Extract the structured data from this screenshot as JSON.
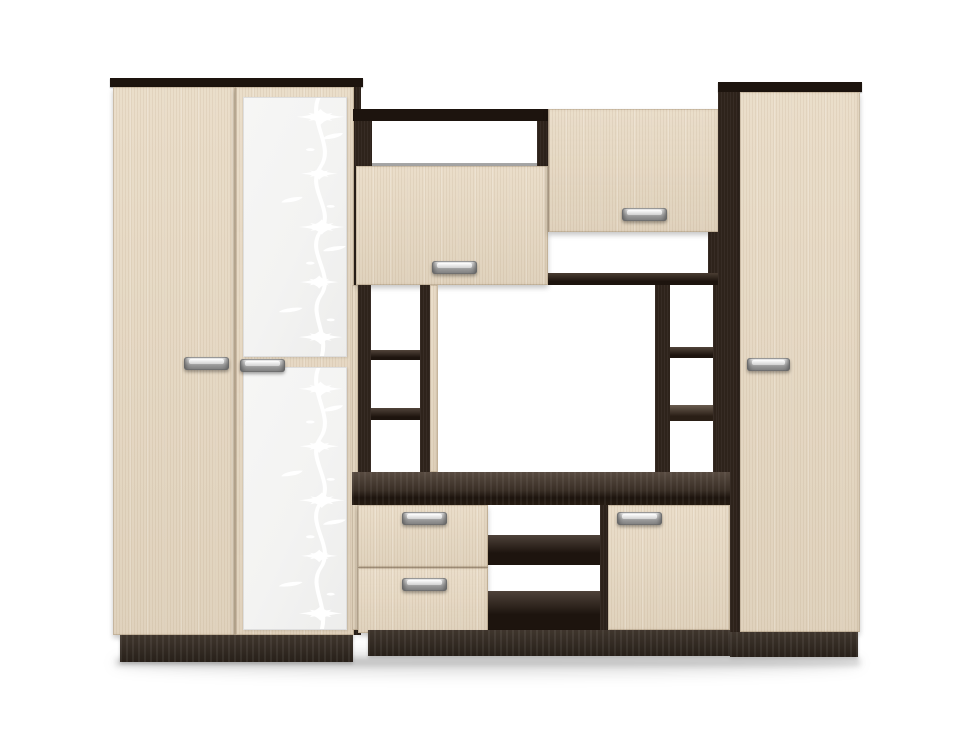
{
  "scene": {
    "kind": "furniture-product-render",
    "object": "living-room wall unit: two-door wardrobe with patterned glass, open TV section with shelves and drawers, tall side cabinet",
    "background": "#ffffff"
  },
  "colors": {
    "background": "#ffffff",
    "wood_light": "#e8dac4",
    "wood_grain": "#d3c1a5",
    "wood_edge": "#cdbb9e",
    "carcass_dark": "#2e231b",
    "carcass_deep": "#1d140e",
    "stand_top": "#584b41",
    "plinth": "#352b22",
    "glass": "#f3f3f2",
    "pattern": "#ffffff",
    "metal_hi": "#f5f5f5",
    "metal_mid": "#c0c0c0",
    "metal_lo": "#7c7c7c",
    "floor_shadow": "rgba(0,0,0,0.12)"
  },
  "parts": {
    "wardrobe": {
      "top_panel": "dark wenge top strip",
      "left_door": {
        "material": "light wood",
        "handle": "aluminum bar"
      },
      "right_door": {
        "material": "light wood",
        "glass_inserts": 2,
        "pattern": "white floral vine on frosted glass",
        "handle": "aluminum bar"
      },
      "side_panel": "dark wenge",
      "plinth": "dark wenge base"
    },
    "center_unit": {
      "top_beam": "dark wenge",
      "open_slot_top_left": "open niche",
      "upper_left_door": {
        "material": "light wood",
        "handle": "aluminum bar"
      },
      "upper_right_door": {
        "material": "light wood",
        "handle": "aluminum bar"
      },
      "open_slot_top_right": "open niche",
      "left_shelf_column": {
        "shelves": 2
      },
      "tv_niche": "open back",
      "right_shelf_column": {
        "shelves": 2
      },
      "tv_stand": "dark wenge worktop",
      "drawers": [
        {
          "handle": "aluminum bar"
        },
        {
          "handle": "aluminum bar"
        }
      ],
      "open_center_shelves": {
        "shelves": 2
      },
      "lower_right_door": {
        "material": "light wood",
        "handle": "aluminum bar"
      },
      "plinth": "dark wenge base"
    },
    "right_cabinet": {
      "top_panel": "dark wenge top strip",
      "side_panel": "dark wenge",
      "door": {
        "material": "light wood",
        "handle": "aluminum bar"
      },
      "plinth": "dark wenge base"
    },
    "hardware": {
      "handle_style": "brushed aluminum bar handle",
      "handle_count": 8
    }
  }
}
